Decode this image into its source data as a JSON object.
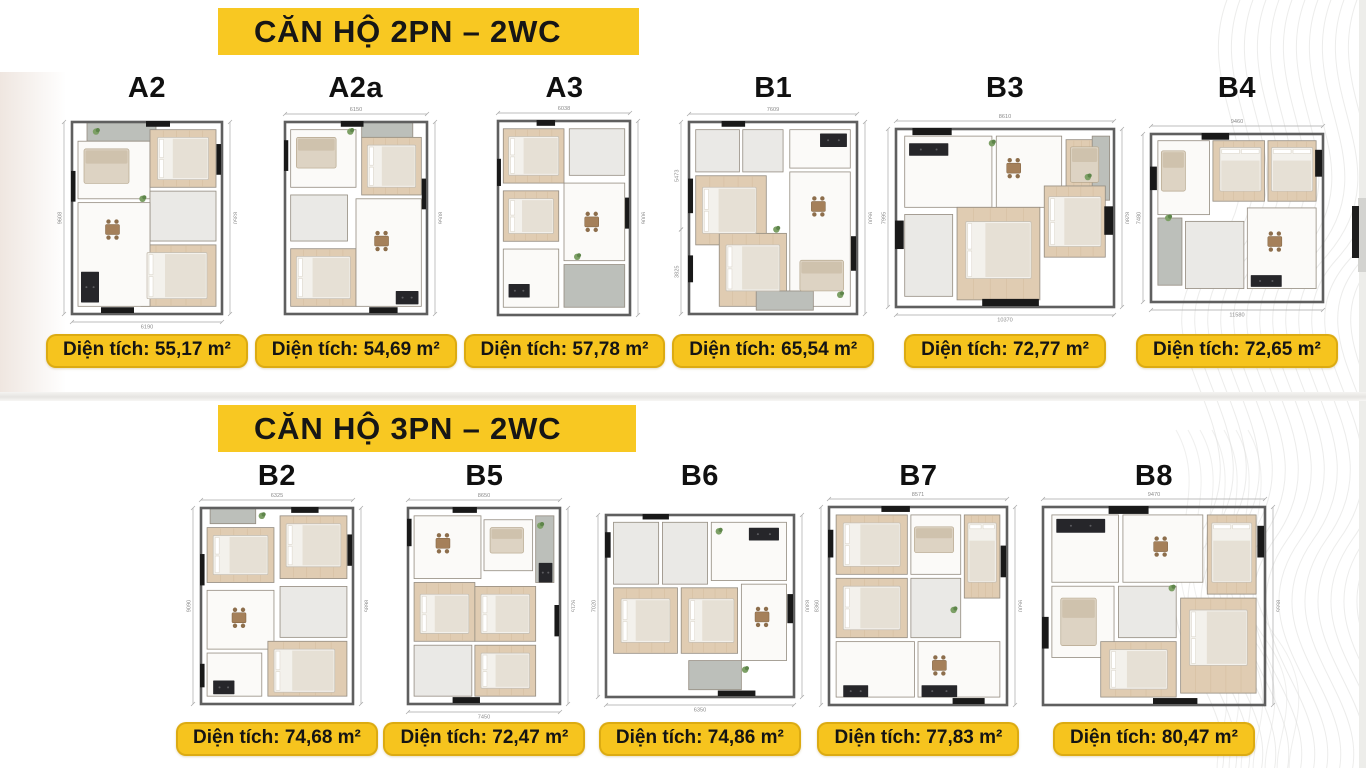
{
  "palette": {
    "accent_yellow": "#f8c822",
    "badge_yellow": "#f6c41e",
    "text_dark": "#141414"
  },
  "sections": [
    {
      "id": "2pn",
      "header": "CĂN HỘ 2PN – 2WC",
      "units": [
        {
          "id": "A2",
          "label": "A2",
          "area": "Diện tích: 55,17 m²",
          "dims": {
            "left": "9608",
            "right": "8350",
            "bottom": "6190"
          }
        },
        {
          "id": "A2a",
          "label": "A2a",
          "area": "Diện tích: 54,69 m²",
          "dims": {
            "top": "6150",
            "right": "8056"
          }
        },
        {
          "id": "A3",
          "label": "A3",
          "area": "Diện tích: 57,78 m²",
          "dims": {
            "top": "6038",
            "right": "9006"
          }
        },
        {
          "id": "B1",
          "label": "B1",
          "area": "Diện tích: 65,54 m²",
          "dims": {
            "top": "7609",
            "left": "5473",
            "left2": "3825",
            "right": "9500"
          }
        },
        {
          "id": "B3",
          "label": "B3",
          "area": "Diện tích: 72,77 m²",
          "dims": {
            "top": "8610",
            "left": "7995",
            "right": "8280",
            "bottom": "10370"
          }
        },
        {
          "id": "B4",
          "label": "B4",
          "area": "Diện tích: 72,65 m²",
          "dims": {
            "top": "9460",
            "left": "7480",
            "bottom": "11580"
          }
        }
      ]
    },
    {
      "id": "3pn",
      "header": "CĂN HỘ 3PN – 2WC",
      "units": [
        {
          "id": "B2",
          "label": "B2",
          "area": "Diện tích: 74,68 m²",
          "dims": {
            "top": "6325",
            "left": "9090",
            "right": "8685"
          }
        },
        {
          "id": "B5",
          "label": "B5",
          "area": "Diện tích: 72,47 m²",
          "dims": {
            "top": "8650",
            "right": "9215",
            "bottom": "7450"
          }
        },
        {
          "id": "B6",
          "label": "B6",
          "area": "Diện tích: 74,86 m²",
          "dims": {
            "left": "7020",
            "right": "8300",
            "bottom": "6350"
          }
        },
        {
          "id": "B7",
          "label": "B7",
          "area": "Diện tích: 77,83 m²",
          "dims": {
            "top": "8571",
            "left": "8360",
            "right": "9500"
          }
        },
        {
          "id": "B8",
          "label": "B8",
          "area": "Diện tích: 80,47 m²",
          "dims": {
            "top": "9470",
            "right": "8555"
          }
        }
      ]
    }
  ]
}
